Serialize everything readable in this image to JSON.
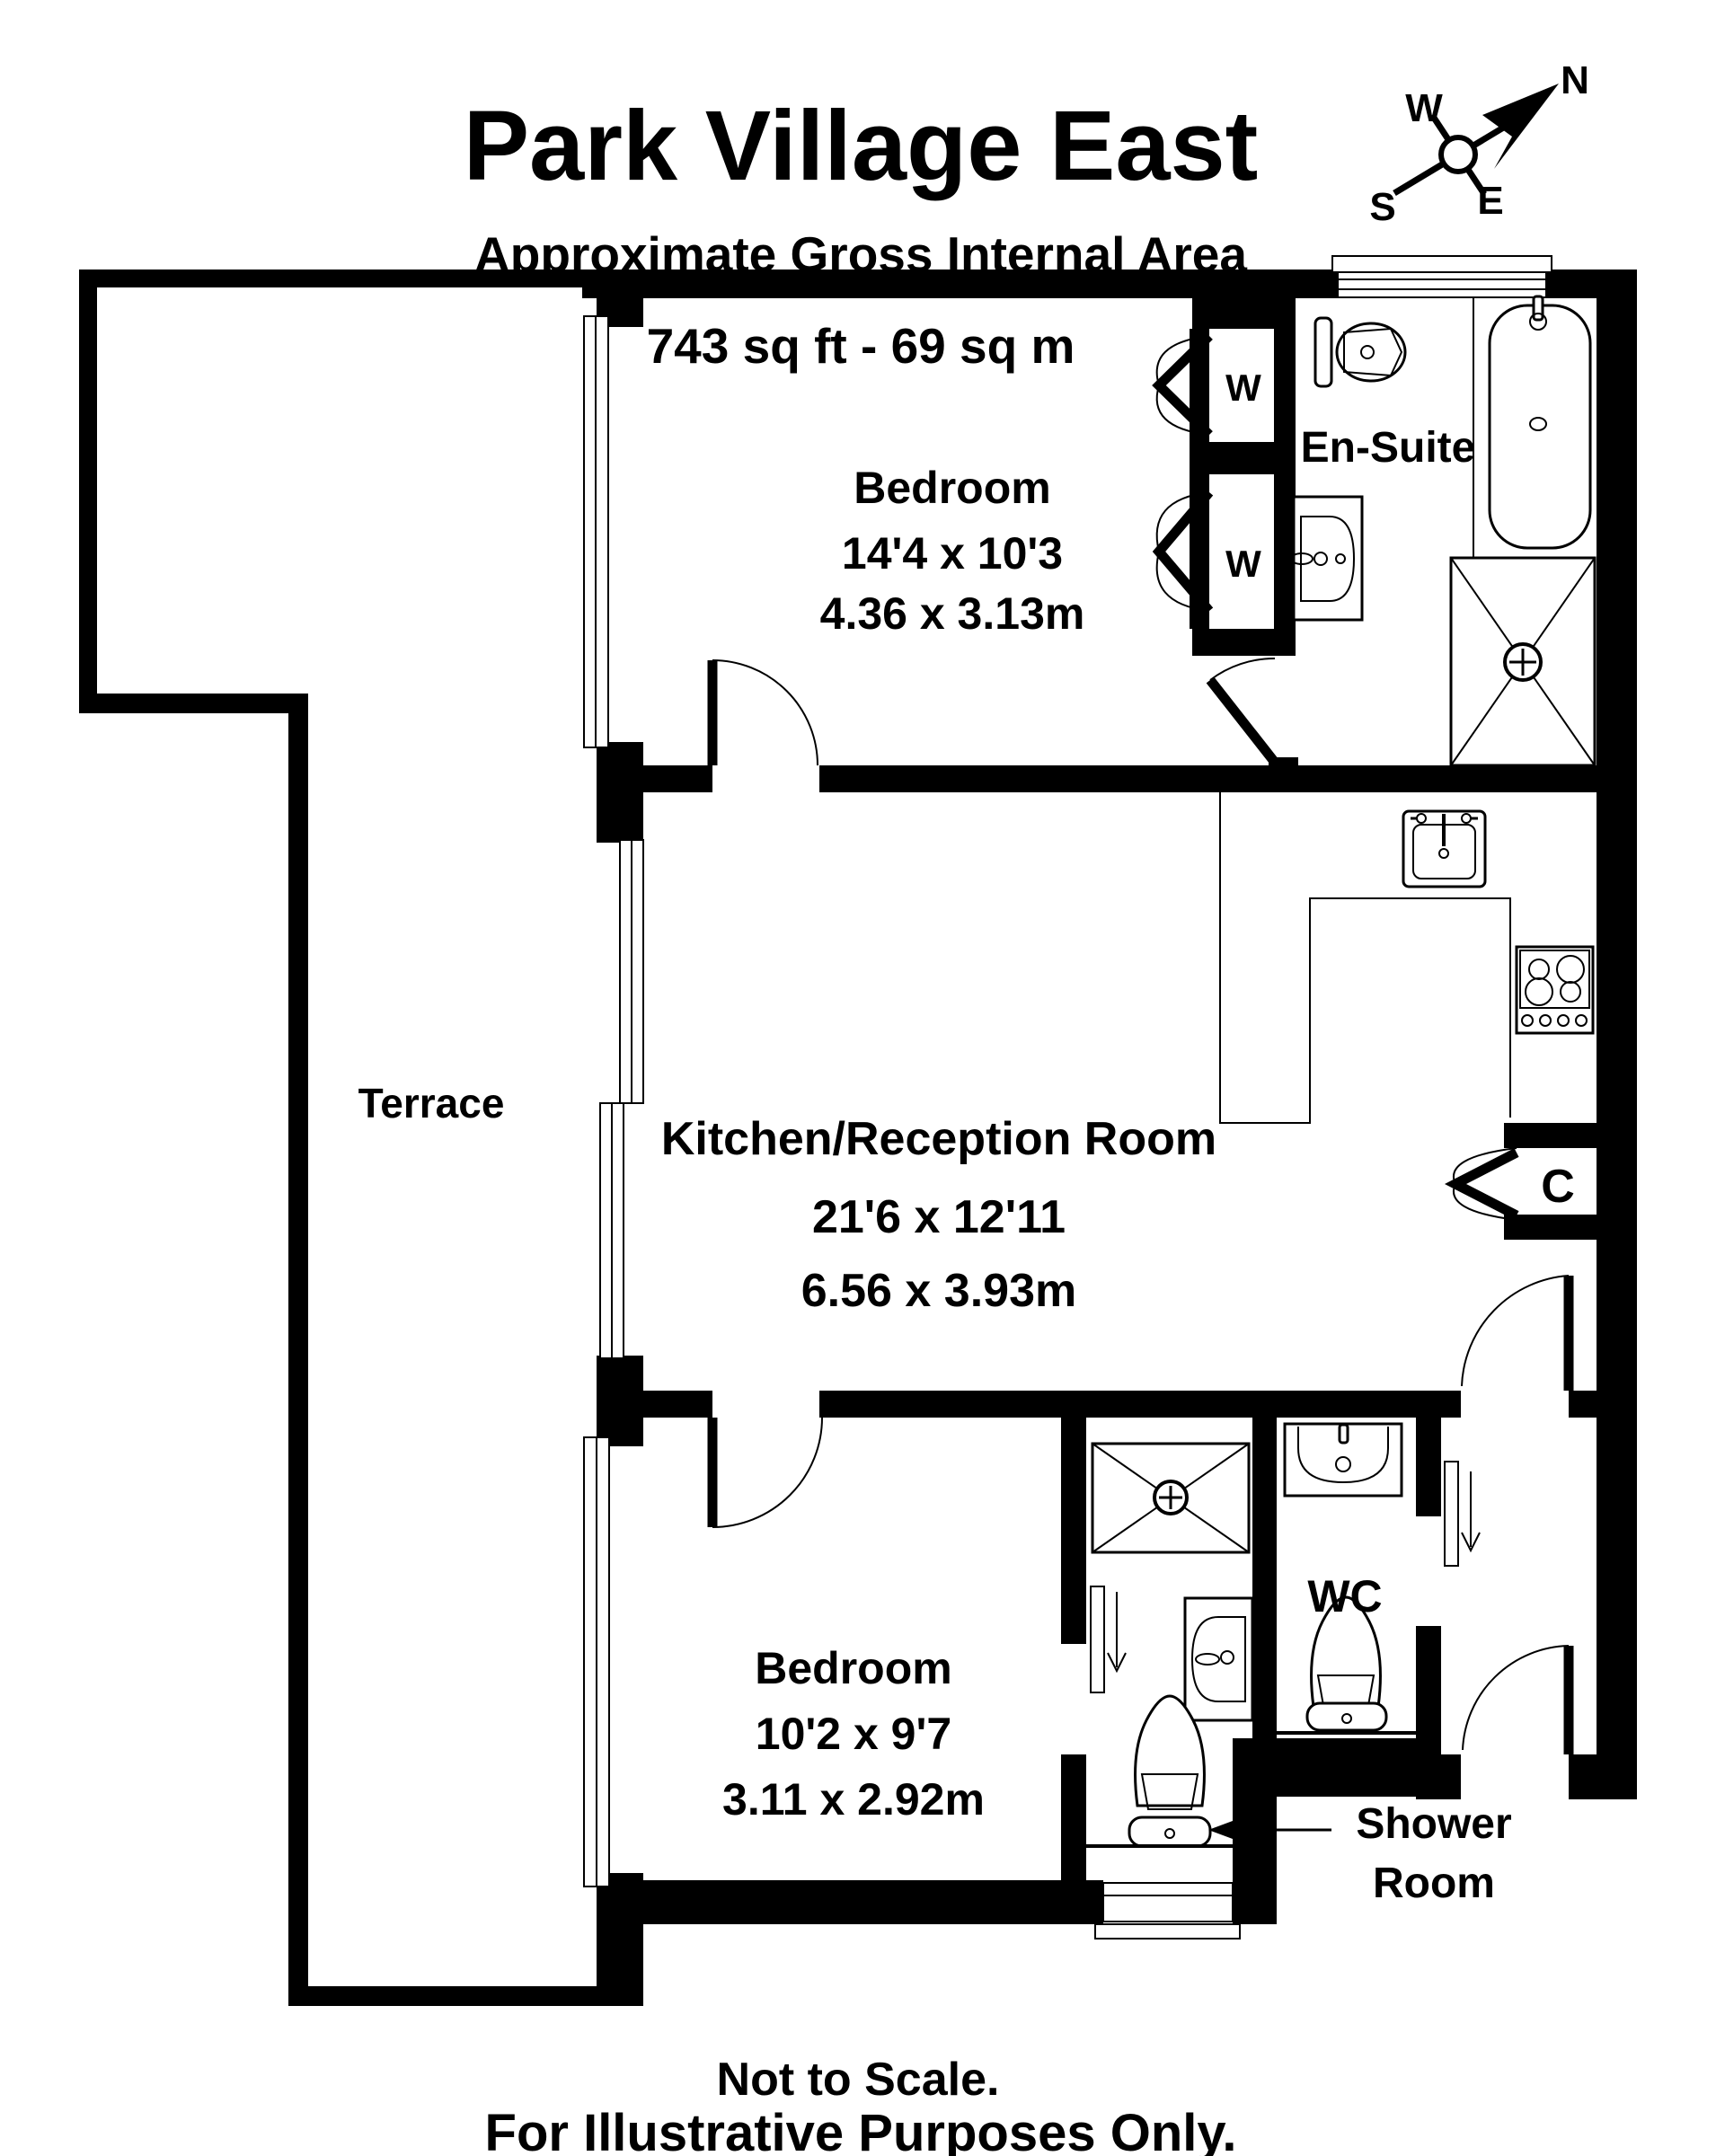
{
  "header": {
    "title": "Park Village East",
    "subtitle": "Approximate Gross Internal Area",
    "area": "743 sq ft - 69 sq m"
  },
  "compass": {
    "north": "N",
    "south": "S",
    "east": "E",
    "west": "W"
  },
  "rooms": {
    "bedroom_top": {
      "name": "Bedroom",
      "imperial": "14'4 x 10'3",
      "metric": "4.36 x 3.13m"
    },
    "en_suite": {
      "name": "En-Suite"
    },
    "kitchen": {
      "name": "Kitchen/Reception Room",
      "imperial": "21'6 x 12'11",
      "metric": "6.56 x 3.93m"
    },
    "terrace": {
      "name": "Terrace"
    },
    "bedroom_bottom": {
      "name": "Bedroom",
      "imperial": "10'2 x 9'7",
      "metric": "3.11 x 2.92m"
    },
    "wc": {
      "name": "WC"
    },
    "shower_room": {
      "line1": "Shower",
      "line2": "Room"
    },
    "closet": {
      "label": "C"
    },
    "wardrobe": {
      "label": "W"
    }
  },
  "footer": {
    "note1": "Not to Scale.",
    "note2": "For Illustrative Purposes Only."
  },
  "colors": {
    "wall": "#000000",
    "background": "#ffffff"
  }
}
